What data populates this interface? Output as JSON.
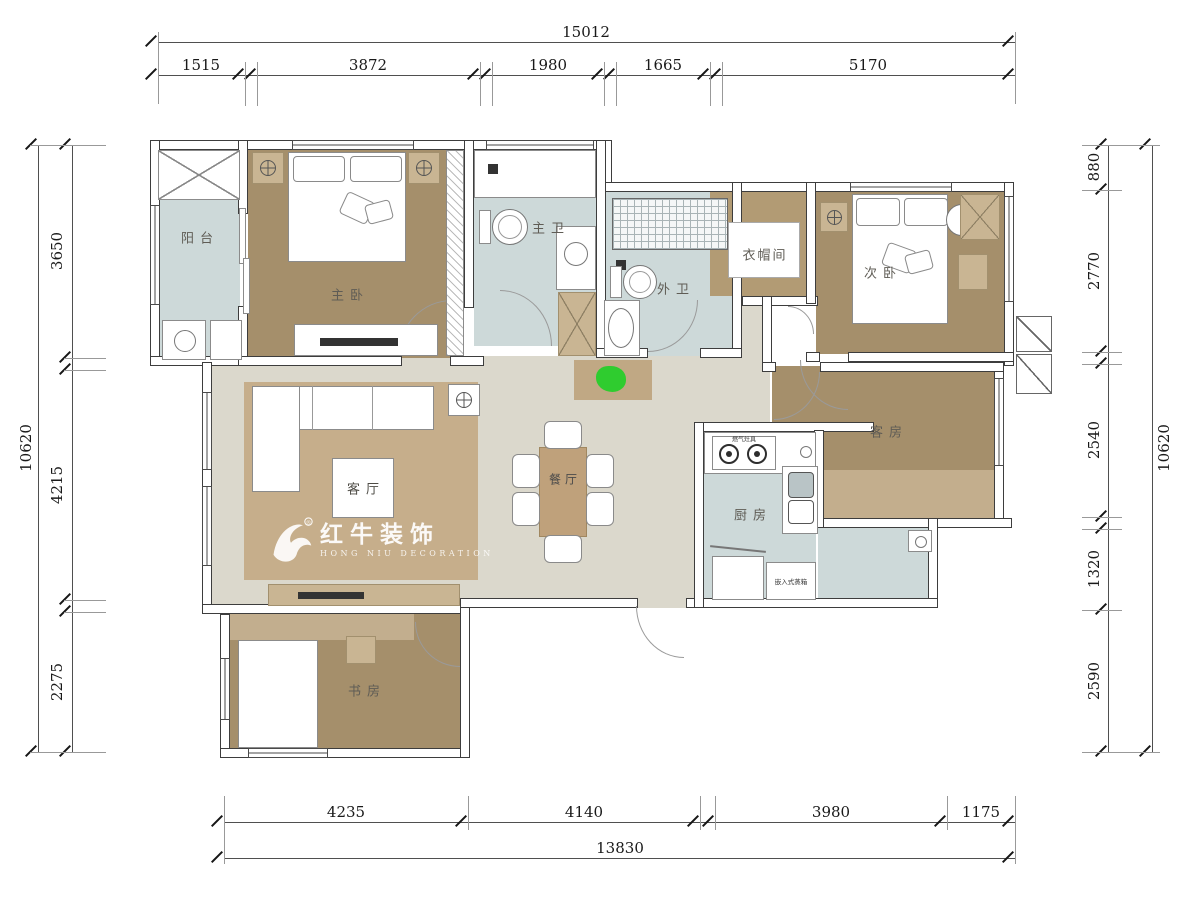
{
  "watermark": {
    "brand": "红牛装饰",
    "subtitle": "HONG NIU DECORATION",
    "registered": "®"
  },
  "rooms": {
    "balcony": "阳台",
    "master_bedroom": "主卧",
    "master_bath": "主卫",
    "outer_bath": "外卫",
    "cloakroom": "衣帽间",
    "second_bedroom": "次卧",
    "living_room": "客厅",
    "dining_room": "餐厅",
    "kitchen": "厨房",
    "guest_room": "客房",
    "study": "书房"
  },
  "appliances": {
    "stove": "燃气灶具",
    "built_in_steamer": "嵌入式蒸箱"
  },
  "dimensions": {
    "top": {
      "total": "15012",
      "segments": [
        "1515",
        "3872",
        "1980",
        "1665",
        "5170"
      ]
    },
    "bottom": {
      "total": "13830",
      "segments": [
        "4235",
        "4140",
        "3980",
        "1175"
      ]
    },
    "left": {
      "total": "10620",
      "segments": [
        "3650",
        "4215",
        "2275"
      ]
    },
    "right": {
      "total": "10620",
      "segments": [
        "880",
        "2770",
        "2540",
        "1320",
        "2590"
      ]
    }
  },
  "colors": {
    "wood_floor": "#a58f6b",
    "area_rug": "#c6ae8b",
    "hall_floor": "#dbd8cc",
    "wet_floor": "#cdd9d9",
    "cloak_floor": "#b29b74",
    "accent_tan": "#c9b593",
    "green_marker": "#2fcc2f"
  }
}
